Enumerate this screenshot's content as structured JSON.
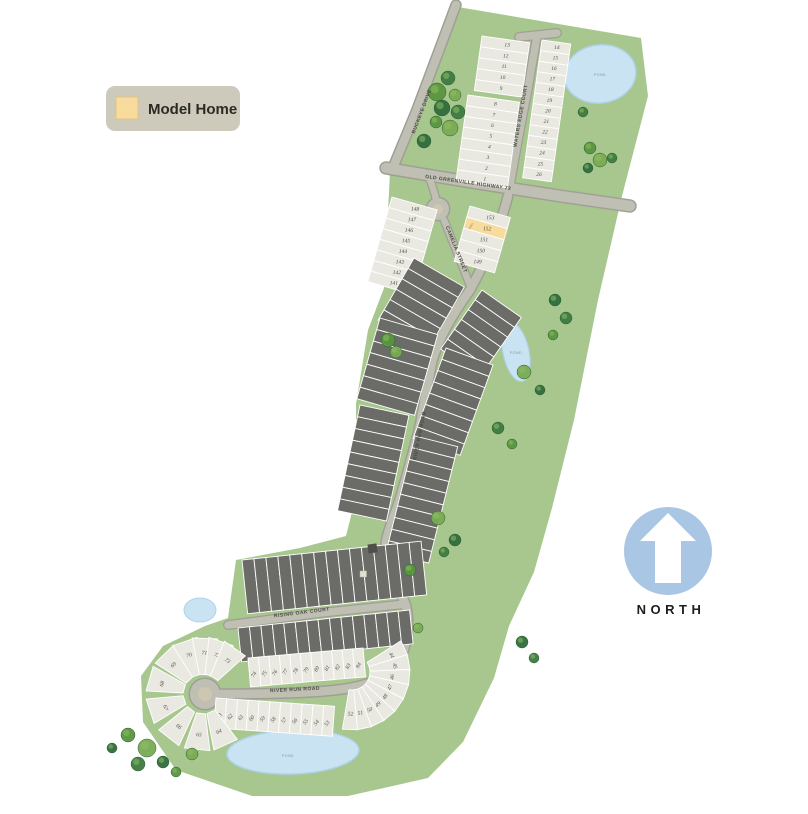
{
  "legend": {
    "label": "Model Home"
  },
  "north": {
    "label": "NORTH"
  },
  "pond_label": "POND",
  "model_label": "MODEL",
  "streets": {
    "buckeye": "BUCKEYE DRIVE",
    "old_greenville": "OLD GREENVILLE HIGHWAY 73",
    "waters_edge": "WATERS EDGE COURT",
    "camelia": "CAMELIA STREET",
    "river_run_spine": "RIVER RUN ROAD",
    "rising_oak": "RISING OAK COURT",
    "river_run": "RIVER RUN ROAD"
  },
  "colors": {
    "site_green": "#a8c78e",
    "road_fill": "#bfbfb3",
    "road_casing": "#9f9f95",
    "lot_light": "#e9e8e1",
    "lot_dark": "#6b6b67",
    "lot_stroke": "#ffffff",
    "model_lot": "#f7dc9e",
    "pond": "#c9e3f2",
    "pond_edge": "#aed2e8",
    "north_blue": "#a9c6e4",
    "legend_bg": "#cdcabc"
  },
  "model_lot_number": "152",
  "lot_groups": [
    {
      "name": "waters-edge-west-upper",
      "type": "row",
      "x": 482,
      "y": 36,
      "angle": 8,
      "stack": "y",
      "w": 48,
      "h": 11,
      "count": 5,
      "fill": "light",
      "numbers": [
        "13",
        "12",
        "11",
        "10",
        "9"
      ],
      "numAngle": -8
    },
    {
      "name": "waters-edge-west-lower",
      "type": "row",
      "x": 468,
      "y": 95,
      "angle": 8,
      "stack": "y",
      "w": 52,
      "h": 10.8,
      "count": 8,
      "fill": "light",
      "numbers": [
        "8",
        "7",
        "6",
        "5",
        "4",
        "3",
        "2",
        "1"
      ],
      "numAngle": -8
    },
    {
      "name": "waters-edge-east",
      "type": "row",
      "x": 542,
      "y": 40,
      "angle": 8,
      "stack": "y",
      "w": 29,
      "h": 10.7,
      "count": 13,
      "fill": "light",
      "numbers": [
        "14",
        "15",
        "16",
        "17",
        "18",
        "19",
        "20",
        "21",
        "22",
        "23",
        "24",
        "25",
        "26"
      ],
      "numAngle": -8
    },
    {
      "name": "camelia-west",
      "type": "row",
      "x": 392,
      "y": 197,
      "angle": 16,
      "stack": "y",
      "w": 47,
      "h": 11,
      "count": 8,
      "fill": "light",
      "numbers": [
        "148",
        "147",
        "146",
        "145",
        "144",
        "143",
        "142",
        "141"
      ],
      "numAngle": -14
    },
    {
      "name": "camelia-east",
      "type": "row",
      "x": 470,
      "y": 206,
      "angle": 16,
      "stack": "y",
      "w": 42,
      "h": 11.5,
      "count": 5,
      "fill": "light",
      "numbers": [
        "153",
        "152",
        "151",
        "150",
        "149"
      ],
      "numAngle": -14,
      "model_index": 1
    },
    {
      "name": "mid-west-1",
      "type": "row",
      "x": 414,
      "y": 258,
      "angle": 30,
      "stack": "y",
      "w": 58,
      "h": 12,
      "count": 6,
      "fill": "dark"
    },
    {
      "name": "mid-west-2",
      "type": "row",
      "x": 380,
      "y": 318,
      "angle": 16,
      "stack": "y",
      "w": 60,
      "h": 12,
      "count": 7,
      "fill": "dark"
    },
    {
      "name": "mid-west-3",
      "type": "row",
      "x": 360,
      "y": 405,
      "angle": 12,
      "stack": "y",
      "w": 50,
      "h": 12,
      "count": 9,
      "fill": "dark"
    },
    {
      "name": "mid-east-1",
      "type": "row",
      "x": 482,
      "y": 290,
      "angle": 35,
      "stack": "y",
      "w": 48,
      "h": 12,
      "count": 6,
      "fill": "dark"
    },
    {
      "name": "mid-east-2",
      "type": "row",
      "x": 446,
      "y": 348,
      "angle": 20,
      "stack": "y",
      "w": 50,
      "h": 12,
      "count": 8,
      "fill": "dark"
    },
    {
      "name": "mid-east-3",
      "type": "row",
      "x": 415,
      "y": 436,
      "angle": 14,
      "stack": "y",
      "w": 44,
      "h": 12,
      "count": 10,
      "fill": "dark"
    },
    {
      "name": "rising-oak-north",
      "type": "row",
      "x": 242,
      "y": 560,
      "angle": -6,
      "stack": "x",
      "w": 12,
      "h": 54,
      "count": 15,
      "fill": "dark"
    },
    {
      "name": "rising-oak-south",
      "type": "row",
      "x": 238,
      "y": 628,
      "angle": -6,
      "stack": "x",
      "w": 11.5,
      "h": 34,
      "count": 15,
      "fill": "dark"
    },
    {
      "name": "river-run-north",
      "type": "row",
      "x": 248,
      "y": 658,
      "angle": -5,
      "stack": "x",
      "w": 10.5,
      "h": 29,
      "count": 11,
      "fill": "light",
      "numbers": [
        "74",
        "75",
        "76",
        "77",
        "78",
        "79",
        "80",
        "81",
        "82",
        "83",
        "84"
      ],
      "numAngle": -55
    },
    {
      "name": "river-run-south",
      "type": "row",
      "x": 216,
      "y": 698,
      "angle": 4,
      "stack": "x",
      "w": 10.8,
      "h": 30,
      "count": 11,
      "fill": "light",
      "numbers": [
        "63",
        "62",
        "61",
        "60",
        "59",
        "58",
        "57",
        "56",
        "55",
        "54",
        "53"
      ],
      "numAngle": -55
    },
    {
      "name": "cul-de-sac-fan",
      "type": "radial",
      "cx": 203,
      "cy": 694,
      "r1": 20,
      "r2": 57,
      "halfw": 13,
      "fill": "light",
      "angles": [
        66,
        96,
        128,
        162,
        196,
        226,
        251,
        272,
        289,
        305
      ],
      "numbers": [
        "64",
        "65",
        "66",
        "67",
        "68",
        "69",
        "70",
        "71",
        "72",
        "73"
      ]
    },
    {
      "name": "east-bend-fan",
      "type": "radial",
      "cx": 352,
      "cy": 672,
      "r1": 18,
      "r2": 58,
      "halfw": 7.5,
      "fill": "light",
      "angles": [
        -25,
        -10,
        5,
        20,
        35,
        50,
        64,
        78,
        92
      ],
      "numbers": [
        "44",
        "45",
        "46",
        "47",
        "48",
        "49",
        "50",
        "51",
        "52"
      ]
    }
  ],
  "trees": [
    [
      448,
      78,
      7
    ],
    [
      437,
      92,
      9
    ],
    [
      455,
      95,
      6
    ],
    [
      442,
      108,
      8
    ],
    [
      458,
      112,
      7
    ],
    [
      436,
      122,
      6
    ],
    [
      450,
      128,
      8
    ],
    [
      424,
      141,
      7
    ],
    [
      583,
      112,
      5
    ],
    [
      590,
      148,
      6
    ],
    [
      600,
      160,
      7
    ],
    [
      588,
      168,
      5
    ],
    [
      612,
      158,
      5
    ],
    [
      388,
      340,
      7
    ],
    [
      396,
      352,
      6
    ],
    [
      555,
      300,
      6
    ],
    [
      566,
      318,
      6
    ],
    [
      553,
      335,
      5
    ],
    [
      524,
      372,
      7
    ],
    [
      540,
      390,
      5
    ],
    [
      498,
      428,
      6
    ],
    [
      512,
      444,
      5
    ],
    [
      438,
      518,
      7
    ],
    [
      455,
      540,
      6
    ],
    [
      444,
      552,
      5
    ],
    [
      410,
      570,
      6
    ],
    [
      418,
      628,
      5
    ],
    [
      522,
      642,
      6
    ],
    [
      534,
      658,
      5
    ],
    [
      128,
      735,
      7
    ],
    [
      147,
      748,
      9
    ],
    [
      163,
      762,
      6
    ],
    [
      138,
      764,
      7
    ],
    [
      176,
      772,
      5
    ],
    [
      192,
      754,
      6
    ],
    [
      112,
      748,
      5
    ]
  ],
  "tree_colors": [
    "#3c7a41",
    "#58953f",
    "#79ab52",
    "#2f6b3c"
  ]
}
